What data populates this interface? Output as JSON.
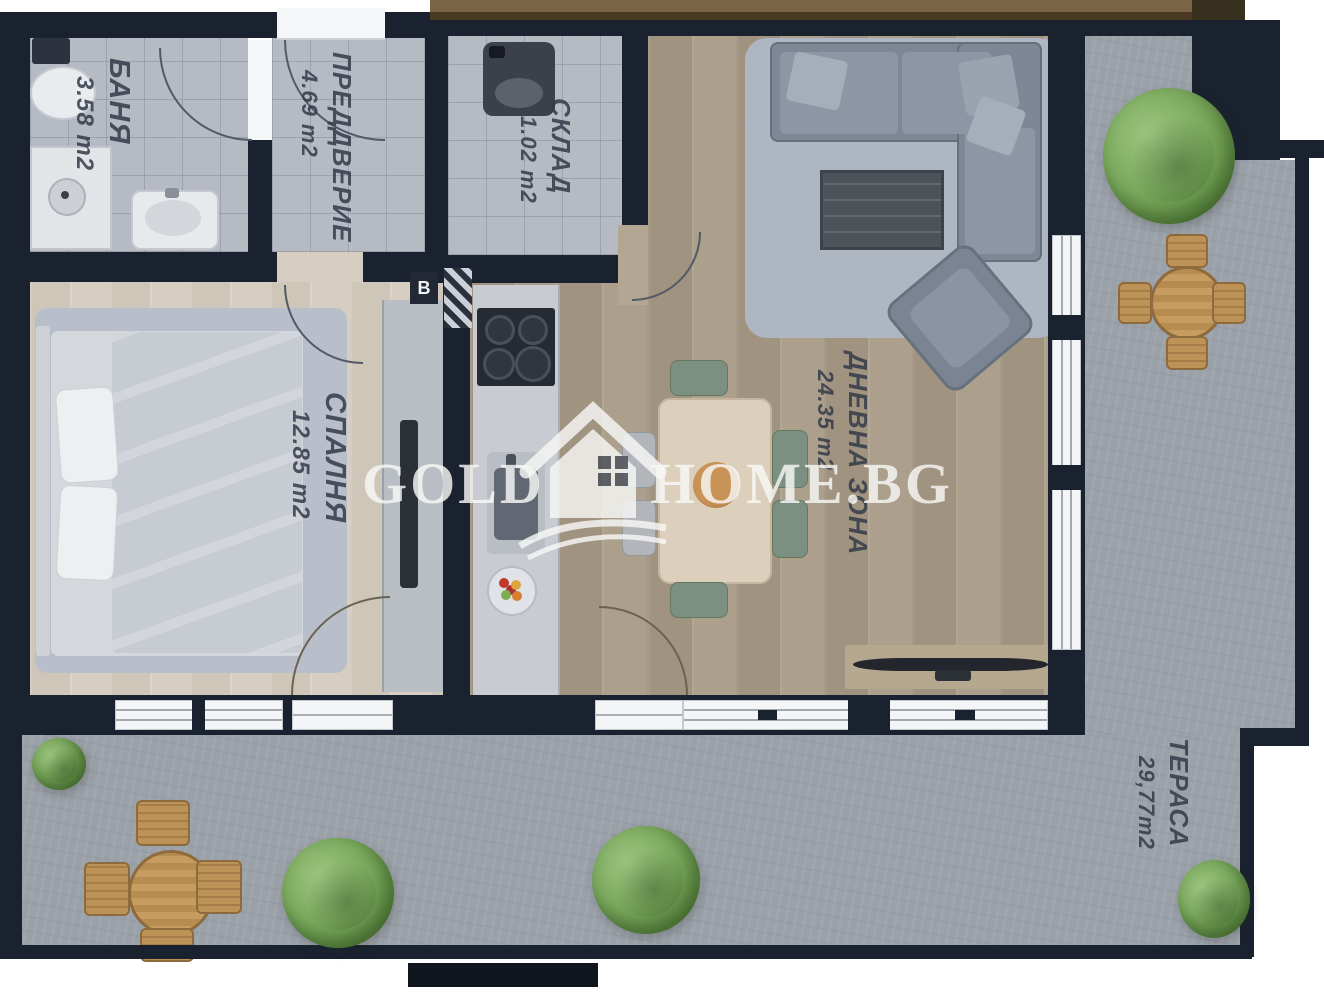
{
  "plan": {
    "watermark": {
      "word_left": "GOLD",
      "word_right": "HOME.BG",
      "icon": "house-logo"
    },
    "rooms": [
      {
        "name": "БАНЯ",
        "area": "3.58 m2"
      },
      {
        "name": "ПРЕДДВЕРИЕ",
        "area": "4.69 m2"
      },
      {
        "name": "СКЛАД",
        "area": "1.02 m2"
      },
      {
        "name": "СПАЛНЯ",
        "area": "12.85 m2"
      },
      {
        "name": "ДНЕВНА ЗОНА",
        "area": "24.35 m2"
      },
      {
        "name": "ТЕРАСА",
        "area": "29,77m2"
      }
    ],
    "markers": {
      "shaft_label": "В"
    },
    "colors": {
      "wall": "#1a2230",
      "tile_floor": "#b6bac3",
      "bedroom_floor": "#d6cfc1",
      "living_floor": "#ac9f8c",
      "terrace_floor": "#9ba1a9",
      "band_brown": "#7a6445",
      "tree_green": "#7cab5e",
      "watermark_white": "#f8f8f6"
    }
  }
}
